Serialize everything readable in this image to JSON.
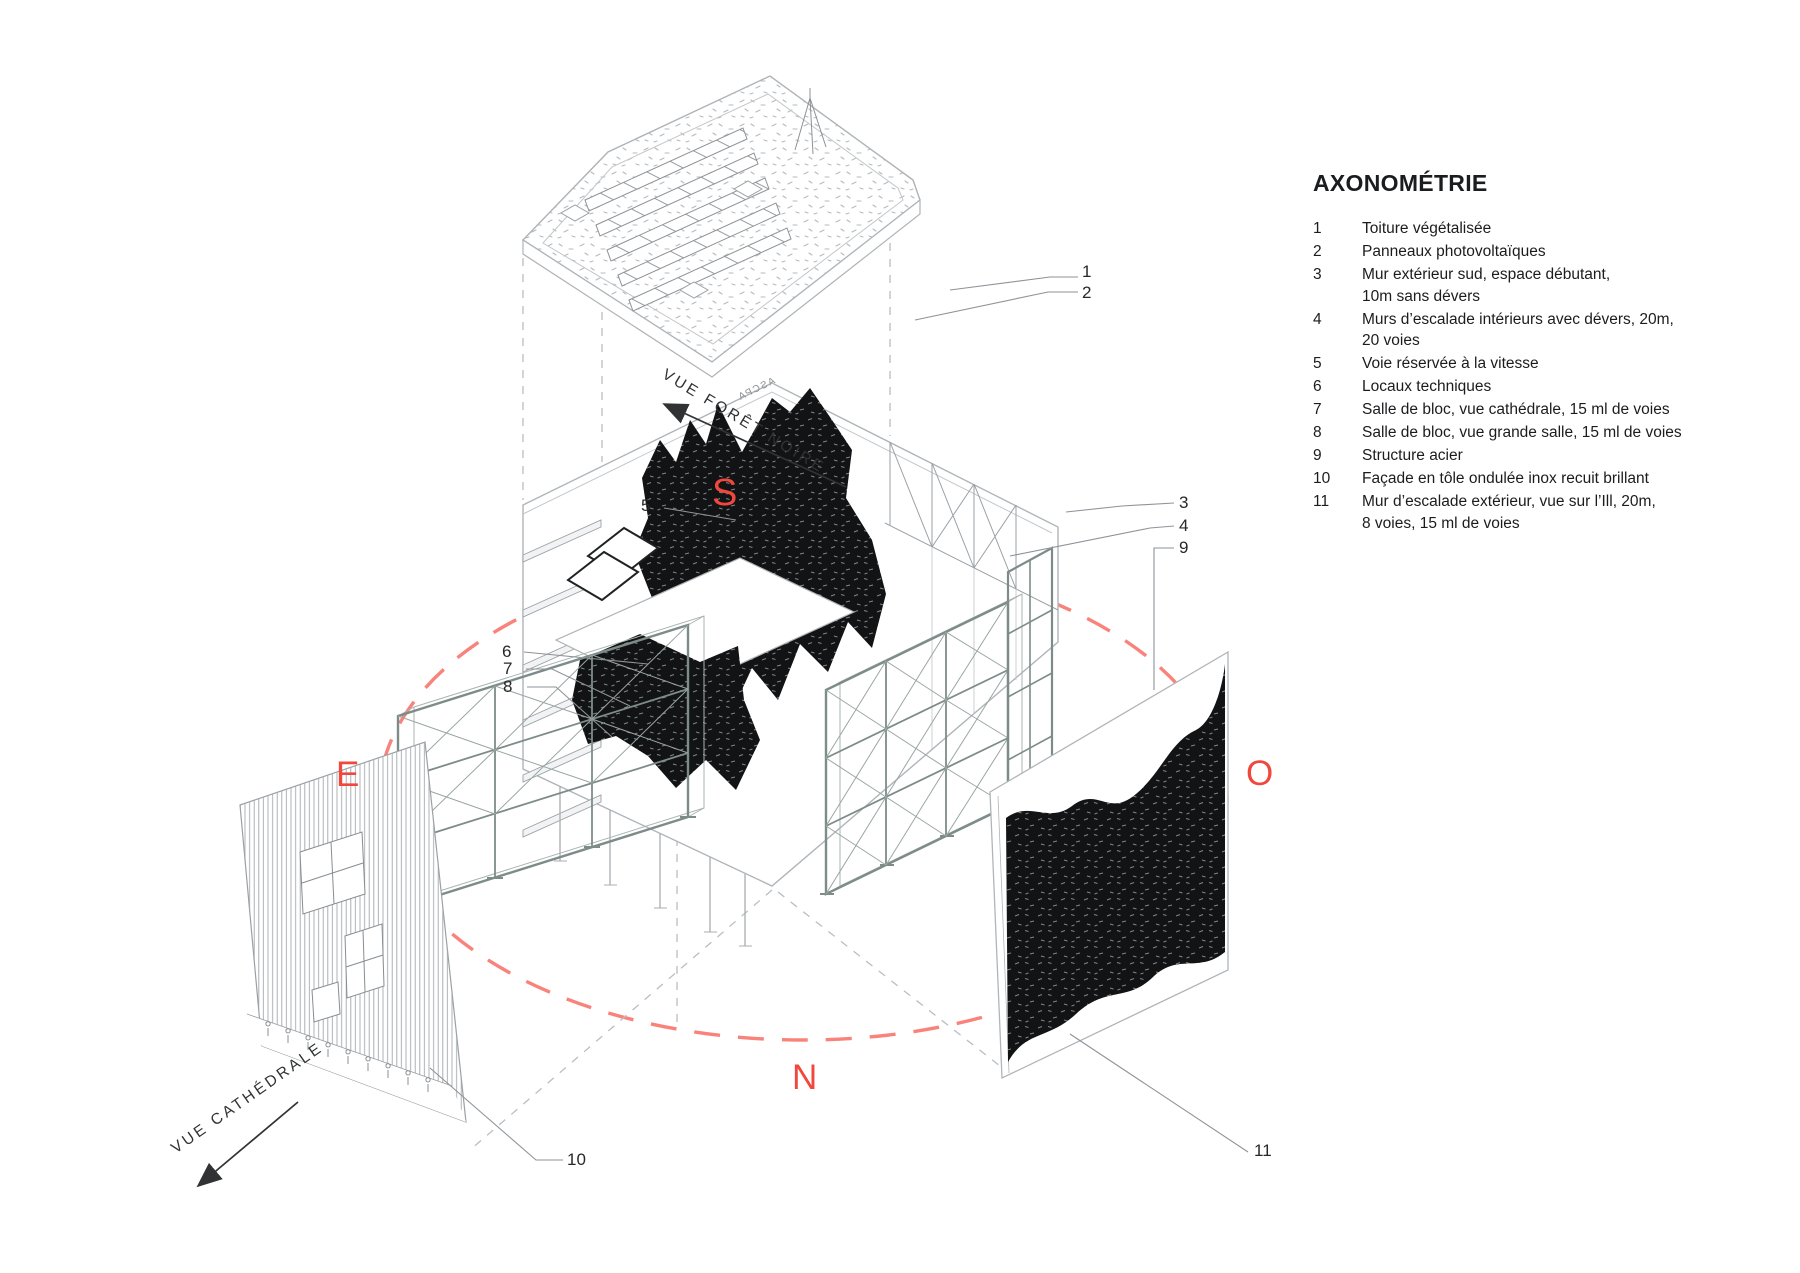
{
  "legend": {
    "title": "AXONOMÉTRIE",
    "items": [
      {
        "num": "1",
        "text": "Toiture végétalisée"
      },
      {
        "num": "2",
        "text": "Panneaux photovoltaïques"
      },
      {
        "num": "3",
        "text": "Mur extérieur sud, espace débutant,\n10m sans dévers"
      },
      {
        "num": "4",
        "text": "Murs d’escalade intérieurs avec dévers, 20m,\n20 voies"
      },
      {
        "num": "5",
        "text": "Voie réservée à la vitesse"
      },
      {
        "num": "6",
        "text": "Locaux techniques"
      },
      {
        "num": "7",
        "text": "Salle de bloc, vue cathédrale, 15 ml de voies"
      },
      {
        "num": "8",
        "text": "Salle de bloc, vue grande salle, 15 ml de voies"
      },
      {
        "num": "9",
        "text": "Structure acier"
      },
      {
        "num": "10",
        "text": "Façade en tôle ondulée inox recuit brillant"
      },
      {
        "num": "11",
        "text": "Mur d’escalade extérieur, vue sur l’Ill, 20m,\n8 voies, 15 ml de voies"
      }
    ]
  },
  "compass": {
    "south": "S",
    "east": "E",
    "west": "O",
    "north": "N"
  },
  "view_labels": {
    "foret_noire": "VUE FORÊT NOIRE",
    "cathedrale": "VUE CATHÉDRALE"
  },
  "callouts": {
    "c1": "1",
    "c2": "2",
    "c3": "3",
    "c4": "4",
    "c5": "5",
    "c6": "6",
    "c7": "7",
    "c8": "8",
    "c9": "9",
    "c10": "10",
    "c11": "11"
  },
  "facade_sign": "ASCPA",
  "colors": {
    "compass_red": "#f2473d",
    "ellipse_red": "#f9837b",
    "steel_gray": "#7d8c89",
    "line_gray": "#9aa0a4",
    "ink": "#1b1c1e"
  }
}
